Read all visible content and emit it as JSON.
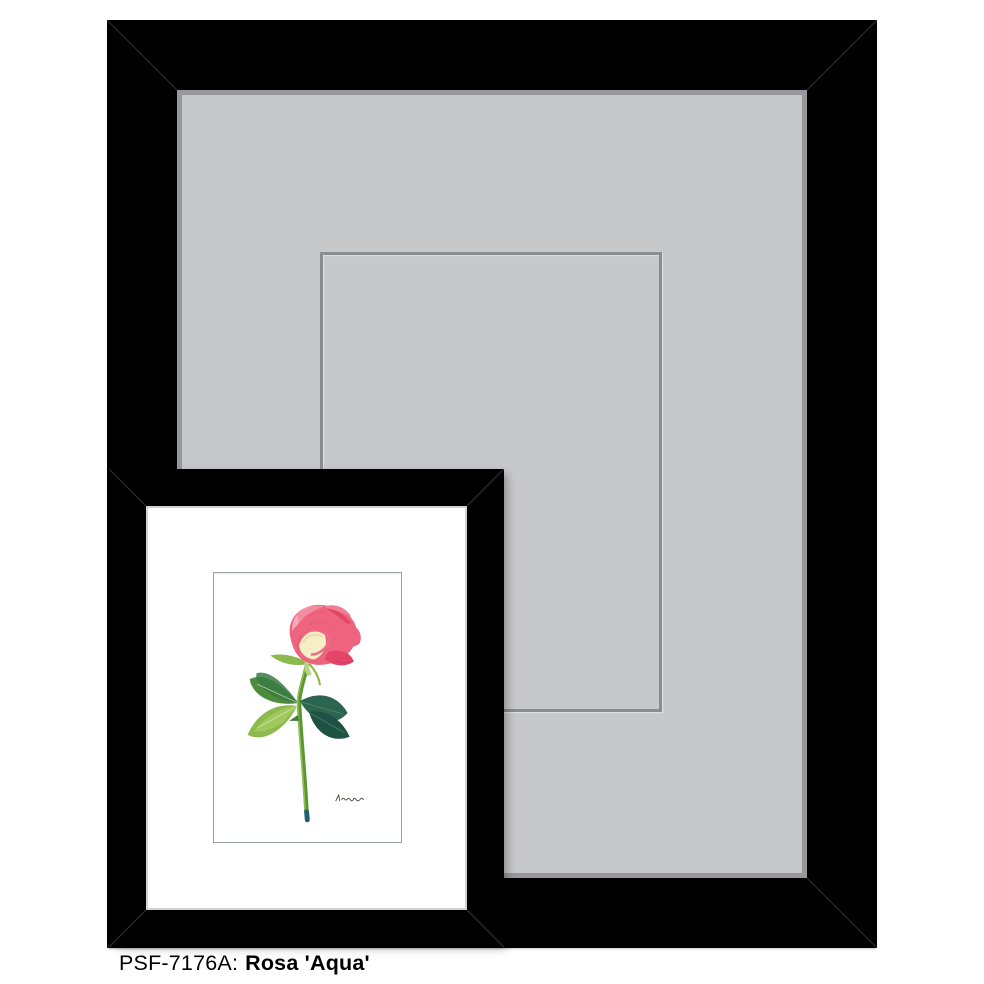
{
  "caption": {
    "sku_label": "PSF-7176A:",
    "artwork_title": "Rosa 'Aqua'"
  },
  "colors": {
    "page_bg": "#ffffff",
    "frame_black": "#000000",
    "miter_line": "#2a2a2a",
    "mat_gray": "#c7c8ca",
    "mat_bevel": "#97999c",
    "opening_line": "#8a8d8f",
    "frame_lip": "#ced2d4",
    "print_paper": "#ffffff",
    "print_border": "#9ba1a4",
    "caption_text": "#000000",
    "rose_pink": "#ee637e",
    "rose_deep": "#e44466",
    "rose_light": "#f6a9b8",
    "rose_cream": "#f5eec6",
    "leaf_dark": "#2d6450",
    "leaf_darker": "#1e5244",
    "leaf_mid": "#4e8c3d",
    "leaf_light": "#8cba4c",
    "stem": "#5a9733",
    "stem_highlight": "#93c455",
    "stem_tip": "#23606b",
    "signature_ink": "#474238"
  }
}
